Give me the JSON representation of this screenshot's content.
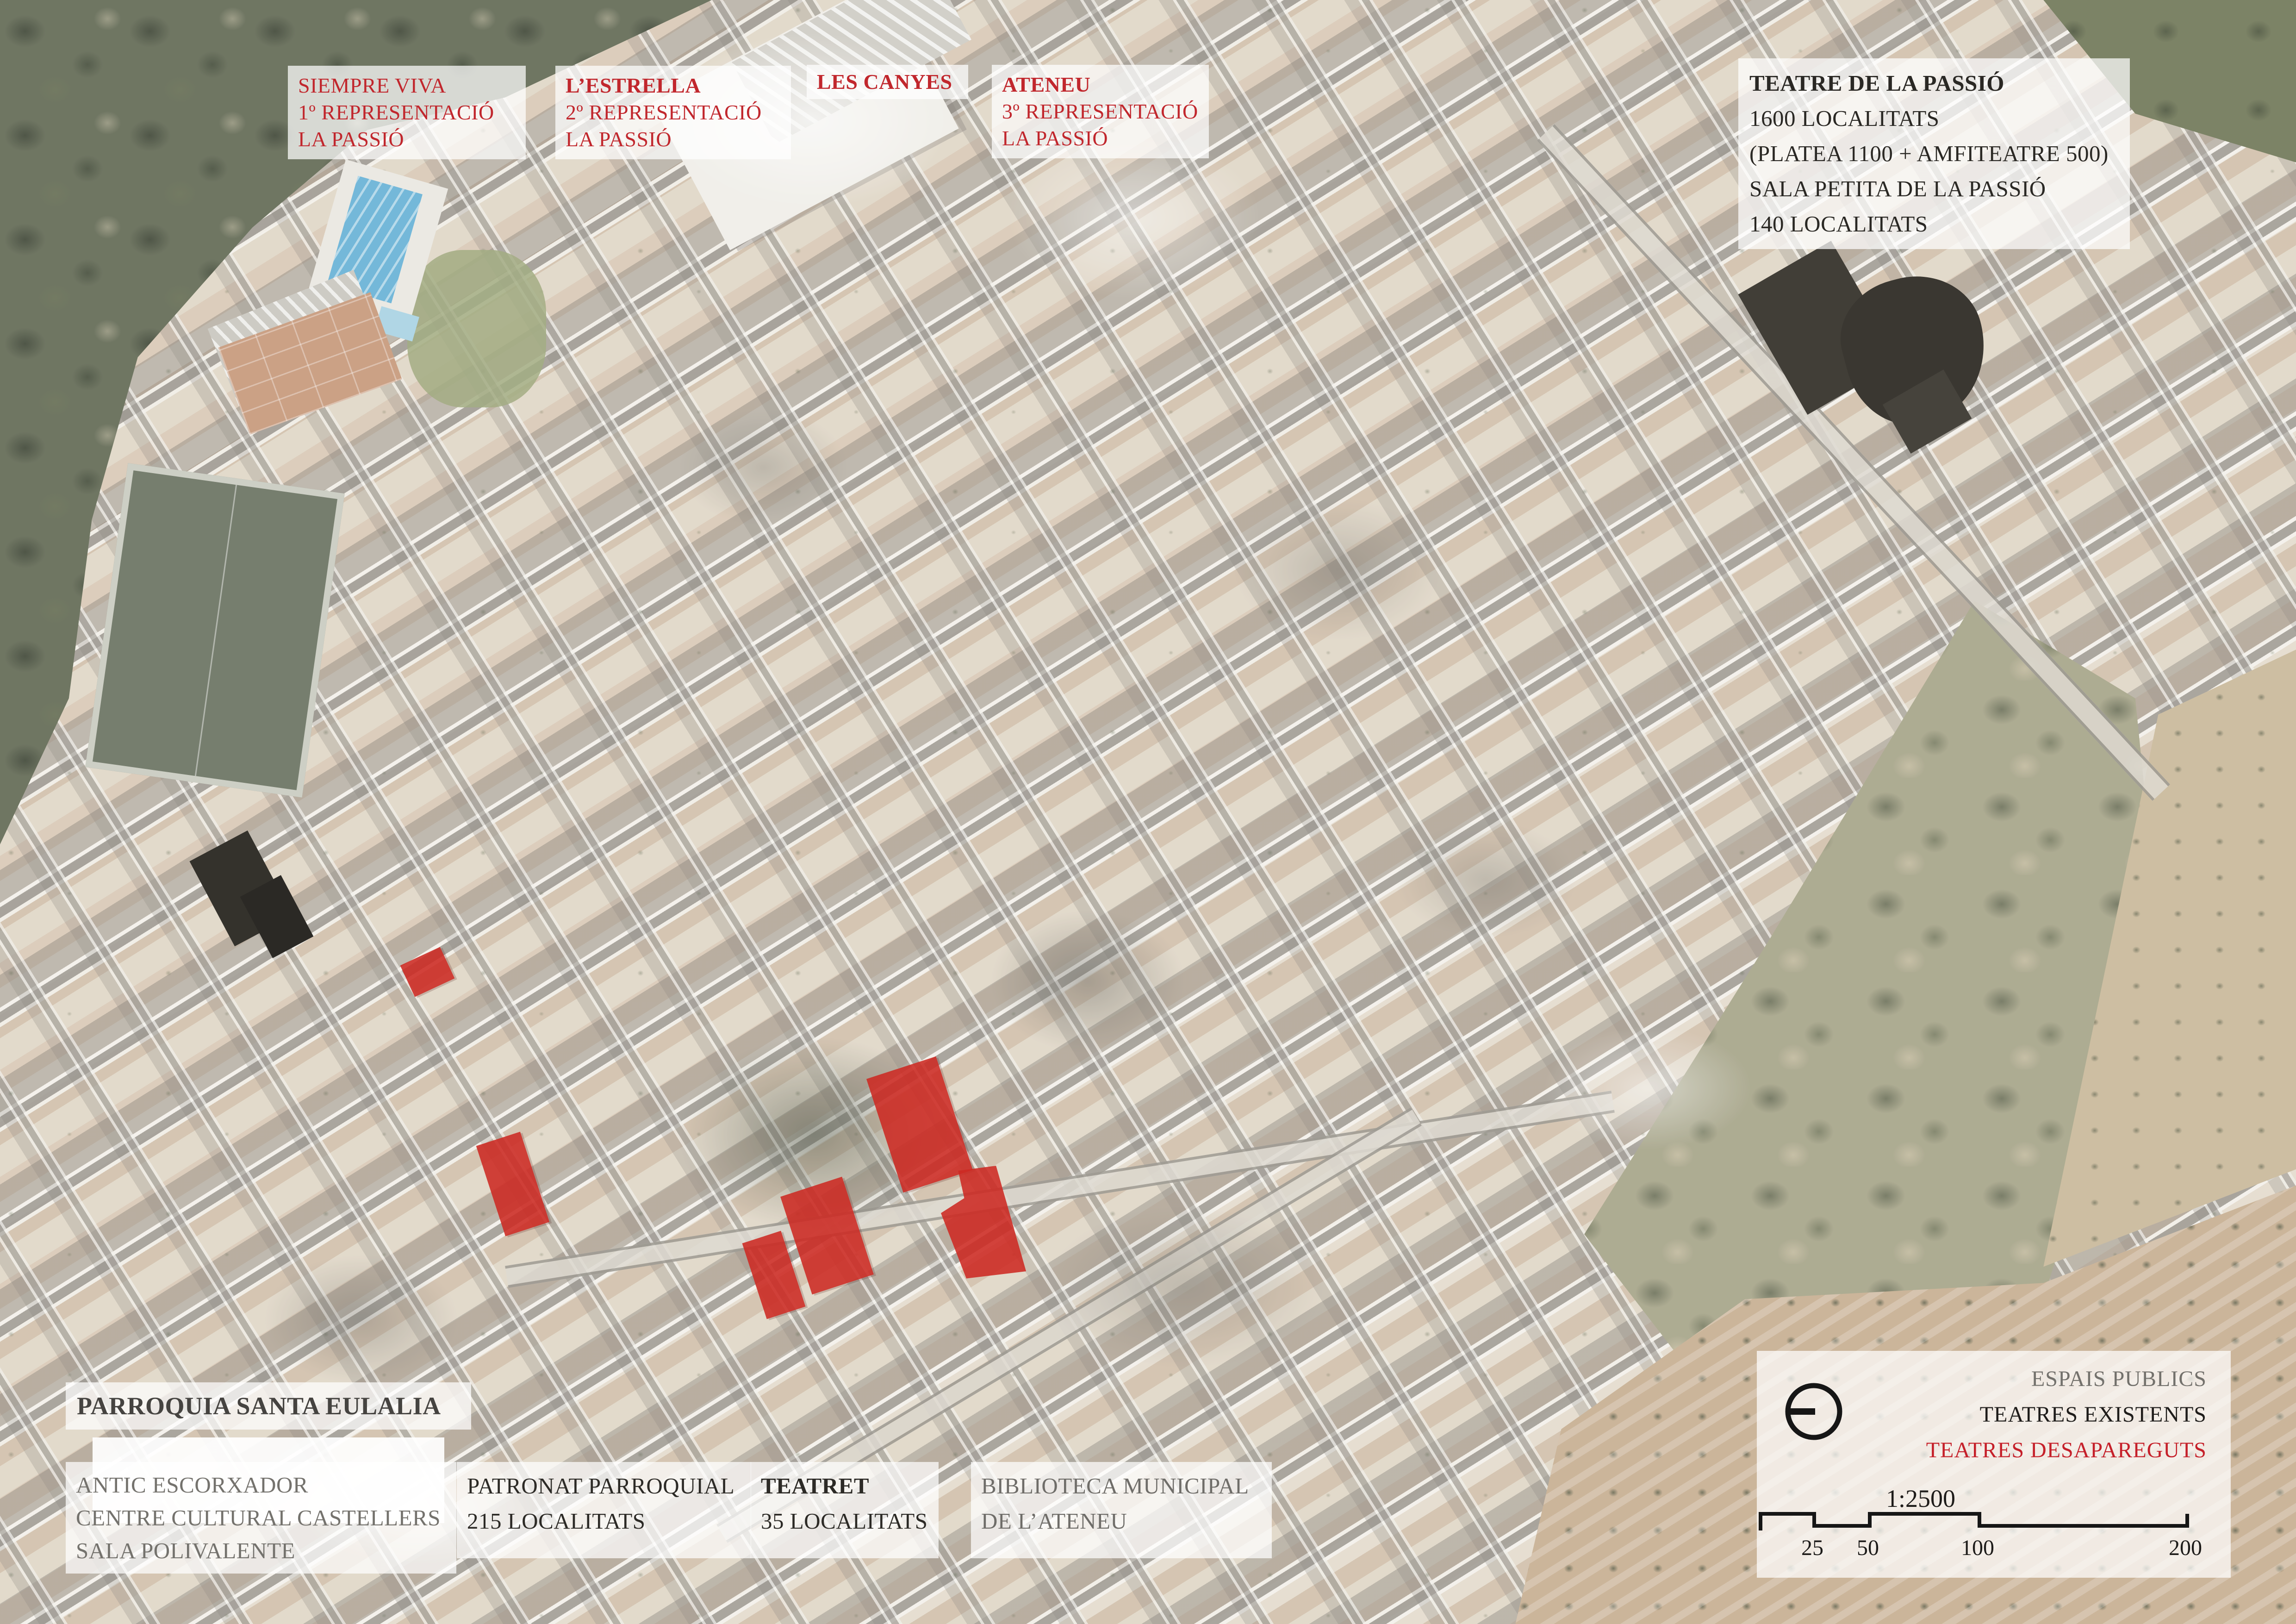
{
  "map_labels": {
    "siempre_viva": [
      "SIEMPRE VIVA",
      "1º REPRESENTACIÓ",
      "LA PASSIÓ"
    ],
    "estrella": [
      "L’ESTRELLA",
      "2º REPRESENTACIÓ",
      "LA PASSIÓ"
    ],
    "les_canyes": [
      "LES CANYES"
    ],
    "ateneu": [
      "ATENEU",
      "3º REPRESENTACIÓ",
      "LA PASSIÓ"
    ],
    "teatre_passio": [
      "TEATRE DE LA PASSIÓ",
      "1600 LOCALITATS",
      "(PLATEA 1100 + AMFITEATRE 500)",
      "SALA PETITA DE LA PASSIÓ",
      "140 LOCALITATS"
    ],
    "parroquia": [
      "PARROQUIA SANTA EULALIA"
    ],
    "antic_escorxador": [
      "ANTIC ESCORXADOR",
      "CENTRE CULTURAL CASTELLERS",
      "SALA POLIVALENTE"
    ],
    "patronat": [
      "PATRONAT PARROQUIAL",
      "215 LOCALITATS"
    ],
    "teatret": [
      "TEATRET",
      "35 LOCALITATS"
    ],
    "biblioteca": [
      "BIBLIOTECA MUNICIPAL",
      "DE L’ATENEU"
    ]
  },
  "legend": {
    "entries": [
      {
        "label": "ESPAIS PUBLICS",
        "color": "#73716c"
      },
      {
        "label": "TEATRES EXISTENTS",
        "color": "#1e1c1a"
      },
      {
        "label": "TEATRES DESAPAREGUTS",
        "color": "#c5202a"
      }
    ],
    "symbol": "circle-with-left-bar",
    "scale": {
      "ratio": "1:2500",
      "ticks": [
        "25",
        "50",
        "100",
        "200"
      ]
    }
  },
  "colors": {
    "annotation_red": "#c1272d",
    "annotation_black": "#2a2824",
    "annotation_gray": "#73716c",
    "highlight_disappeared_red": "#cd2a23",
    "highlight_existing_dark": "#3a3731"
  }
}
